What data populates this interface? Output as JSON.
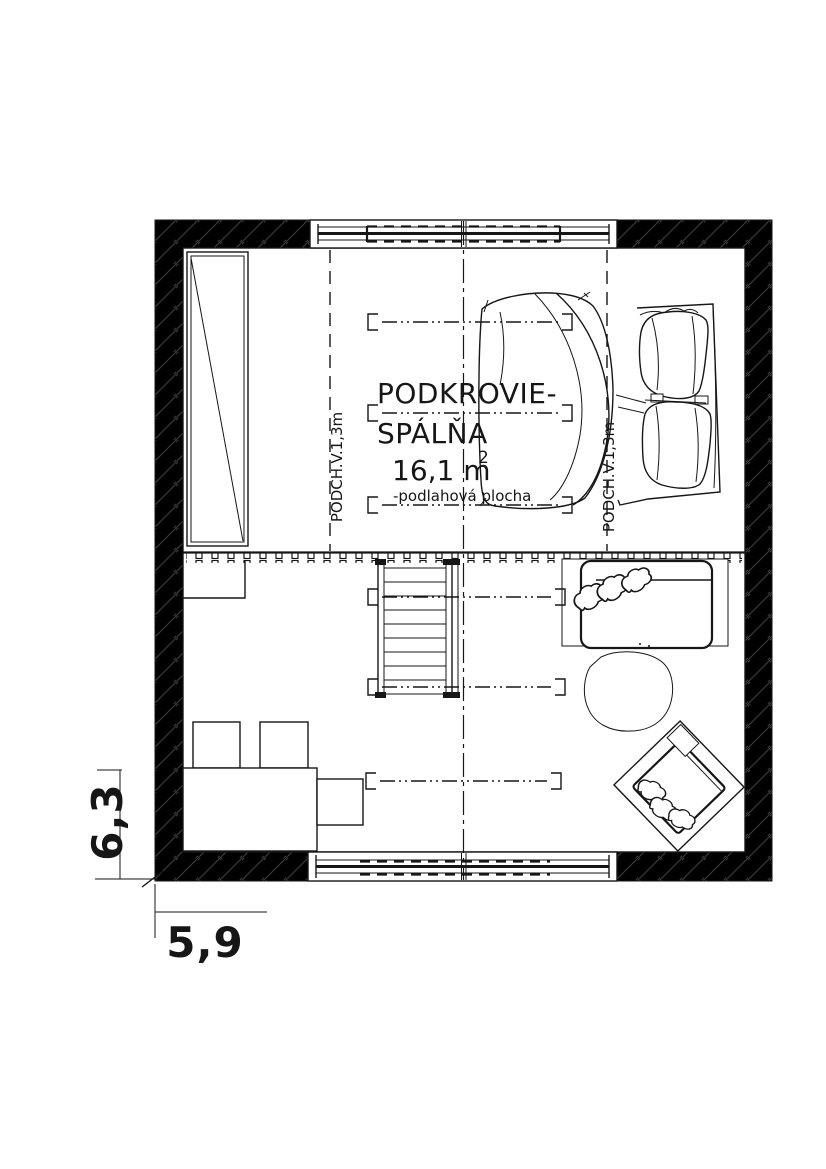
{
  "colors": {
    "ink": "#161616",
    "wall_fill": "#000000",
    "hatch_line": "#3a3a3a",
    "paper": "#ffffff"
  },
  "plan": {
    "room_label_line1": "PODKROVIE-",
    "room_label_line2": "SPÁLŇA",
    "area_value": "16,1 m",
    "area_superscript": "2",
    "area_note": "-podlahová plocha",
    "headroom_label_left": "PODCH.V.1,3m",
    "headroom_label_right": "PODCH.V.1,3m"
  },
  "dimensions": {
    "vertical": "6,3",
    "horizontal": "5,9"
  }
}
